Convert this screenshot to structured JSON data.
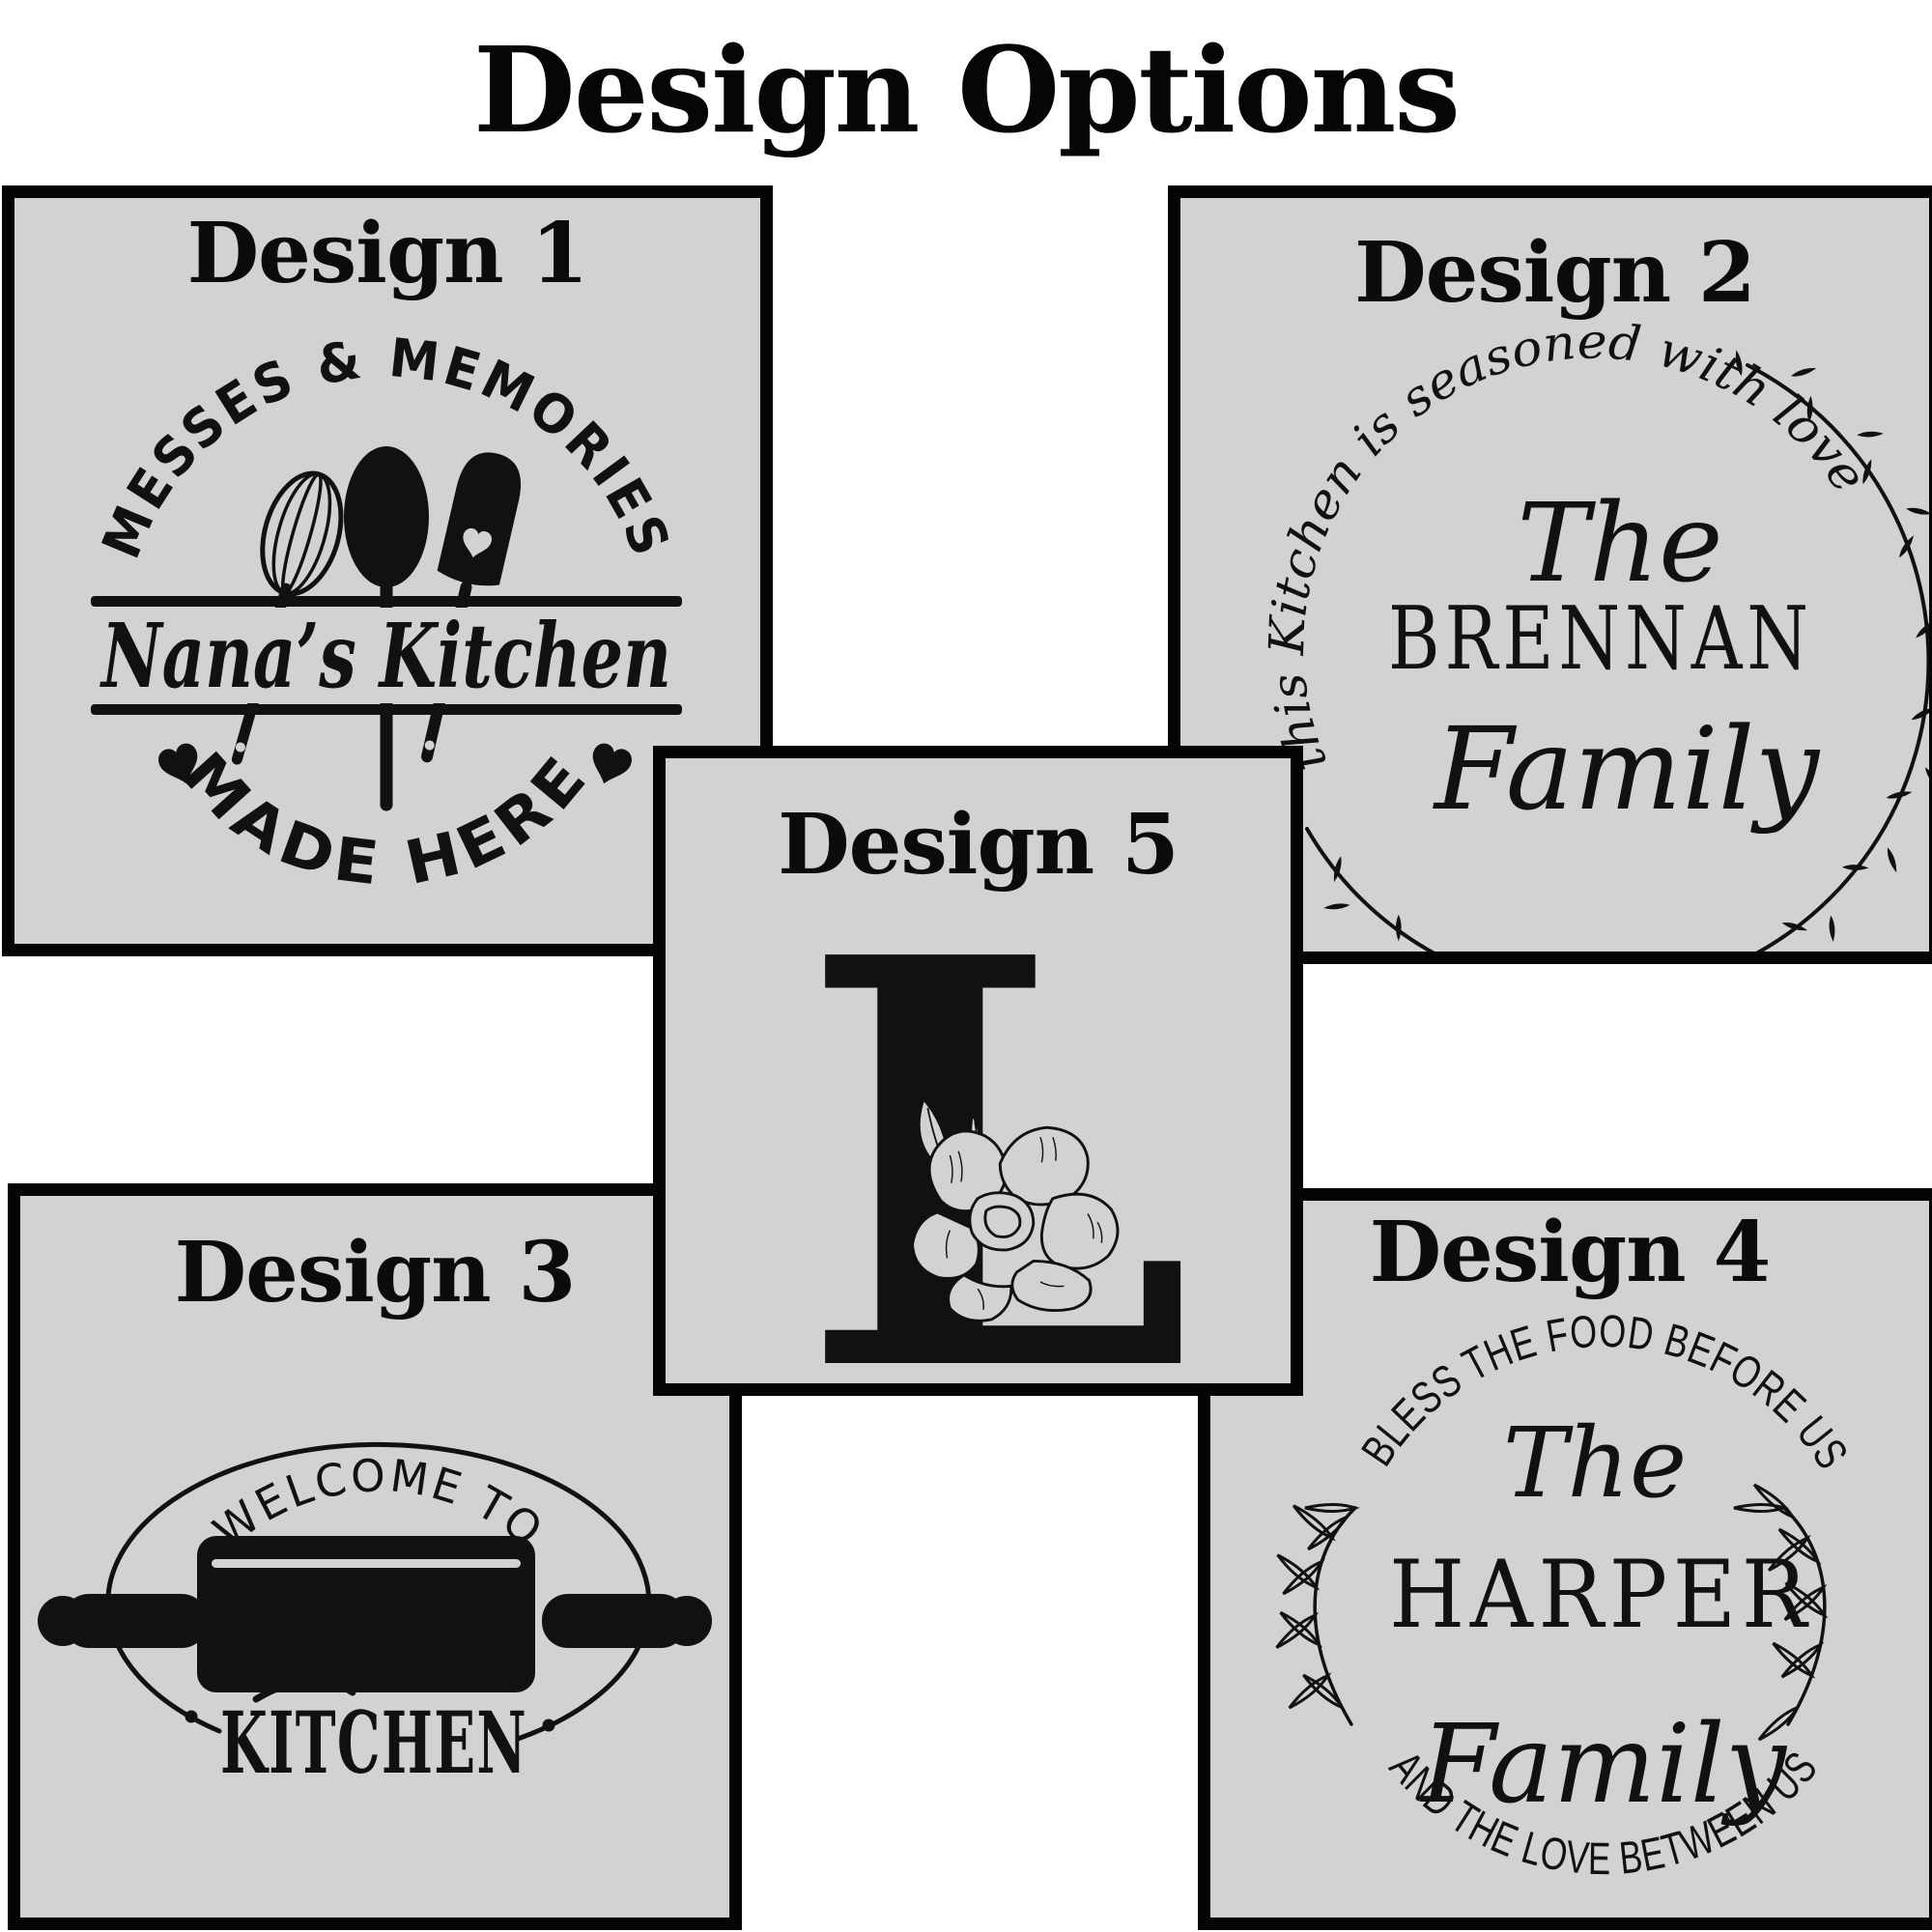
{
  "page_title": "Design Options",
  "colors": {
    "background": "#ffffff",
    "panel_bg": "#d2d2d2",
    "ink": "#111111",
    "border": "#040404",
    "moms_script": "#ffffff"
  },
  "icons": [
    "whisk-icon",
    "spoon-icon",
    "spatula-icon",
    "heart-icon",
    "rolling-pin-icon",
    "wreath-vine-icon",
    "laurel-branch-icon",
    "flower-icon",
    "monogram-letter"
  ],
  "panels": [
    {
      "title": "Design 1",
      "art": {
        "top_arc": "MESSES & MEMORIES",
        "name": "Nana’s Kitchen",
        "bottom_arc": "MADE HERE"
      }
    },
    {
      "title": "Design 2",
      "art": {
        "arc": "this Kitchen is seasoned with love",
        "word1": "The",
        "word2": "BRENNAN",
        "word3": "Family"
      }
    },
    {
      "title": "Design 3",
      "art": {
        "top_arc": "WELCOME TO",
        "name": "Mom’s",
        "word": "KITCHEN"
      }
    },
    {
      "title": "Design 4",
      "art": {
        "top_arc": "BLESS THE FOOD BEFORE US",
        "word1": "The",
        "word2": "HARPER",
        "word3": "Family",
        "bottom_arc": "AND THE LOVE BETWEEN US"
      }
    },
    {
      "title": "Design 5",
      "art": {
        "monogram": "L"
      }
    }
  ]
}
